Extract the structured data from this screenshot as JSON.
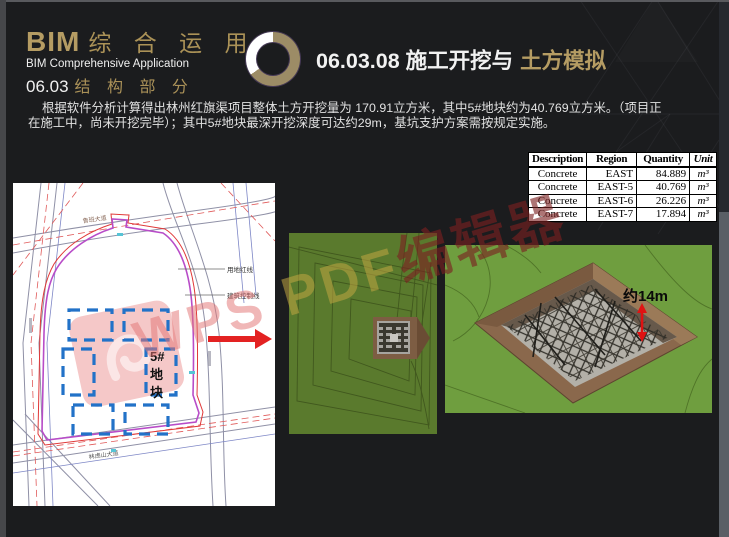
{
  "header": {
    "brand_en": "BIM",
    "brand_cn": "综 合 运 用",
    "brand_sub": "BIM Comprehensive Application",
    "section_num": "06.03",
    "section_cn": "结 构 部 分",
    "title_main": "06.03.08 施工开挖与",
    "title_accent": "土方模拟"
  },
  "body": {
    "line1": "根据软件分析计算得出林州红旗渠项目整体土方开挖量为 170.91立方米，其中5#地块约为40.769立方米。（项目正",
    "line2": "在施工中，尚未开挖完毕）；其中5#地块最深开挖深度可达约29m，基坑支护方案需按规定实施。"
  },
  "quantity_table": {
    "headers": [
      "Description",
      "Region",
      "Quantity",
      "Unit"
    ],
    "rows": [
      [
        "Concrete",
        "EAST",
        "84.889",
        "m³"
      ],
      [
        "Concrete",
        "EAST-5",
        "40.769",
        "m³"
      ],
      [
        "Concrete",
        "EAST-6",
        "26.226",
        "m³"
      ],
      [
        "Concrete",
        "EAST-7",
        "17.894",
        "m³"
      ]
    ]
  },
  "site_plan": {
    "road_label_top": "鲁班大道",
    "road_label_bottom": "林虑山大道",
    "callout_red_line": "用地红线",
    "callout_control_line": "建筑控制线",
    "block_chars": [
      "5#",
      "地",
      "块"
    ]
  },
  "models": {
    "right_depth_label": "约14m"
  },
  "watermark": {
    "part_wps": "WPS ",
    "part_pdf": "PDF",
    "part_cn": "编辑器"
  },
  "colors": {
    "accent_gold": "#b59c63",
    "watermark_pink": "#e27474",
    "arrow_red": "#e32222",
    "terrain_green_mid": "#5a7a2d",
    "terrain_green_right": "#6f9e3f",
    "pit_brown": "#8a684c"
  }
}
